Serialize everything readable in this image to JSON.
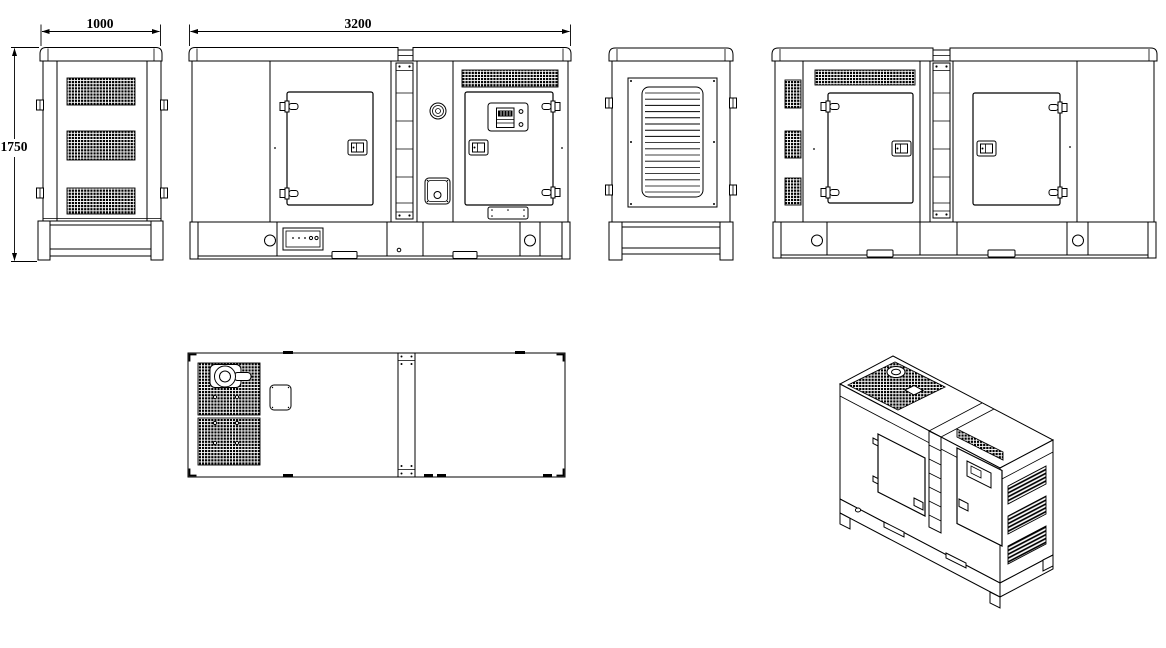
{
  "drawing": {
    "type": "technical-orthographic-drawing",
    "subject": "silent-diesel-generator-set-canopy",
    "background_color": "#ffffff",
    "line_color": "#000000",
    "dimensions": {
      "width_label": "1000",
      "length_label": "3200",
      "height_label": "1750"
    },
    "views": [
      "end-view-front",
      "side-view-a",
      "end-view-rear",
      "side-view-b",
      "top-view",
      "isometric-view"
    ]
  }
}
